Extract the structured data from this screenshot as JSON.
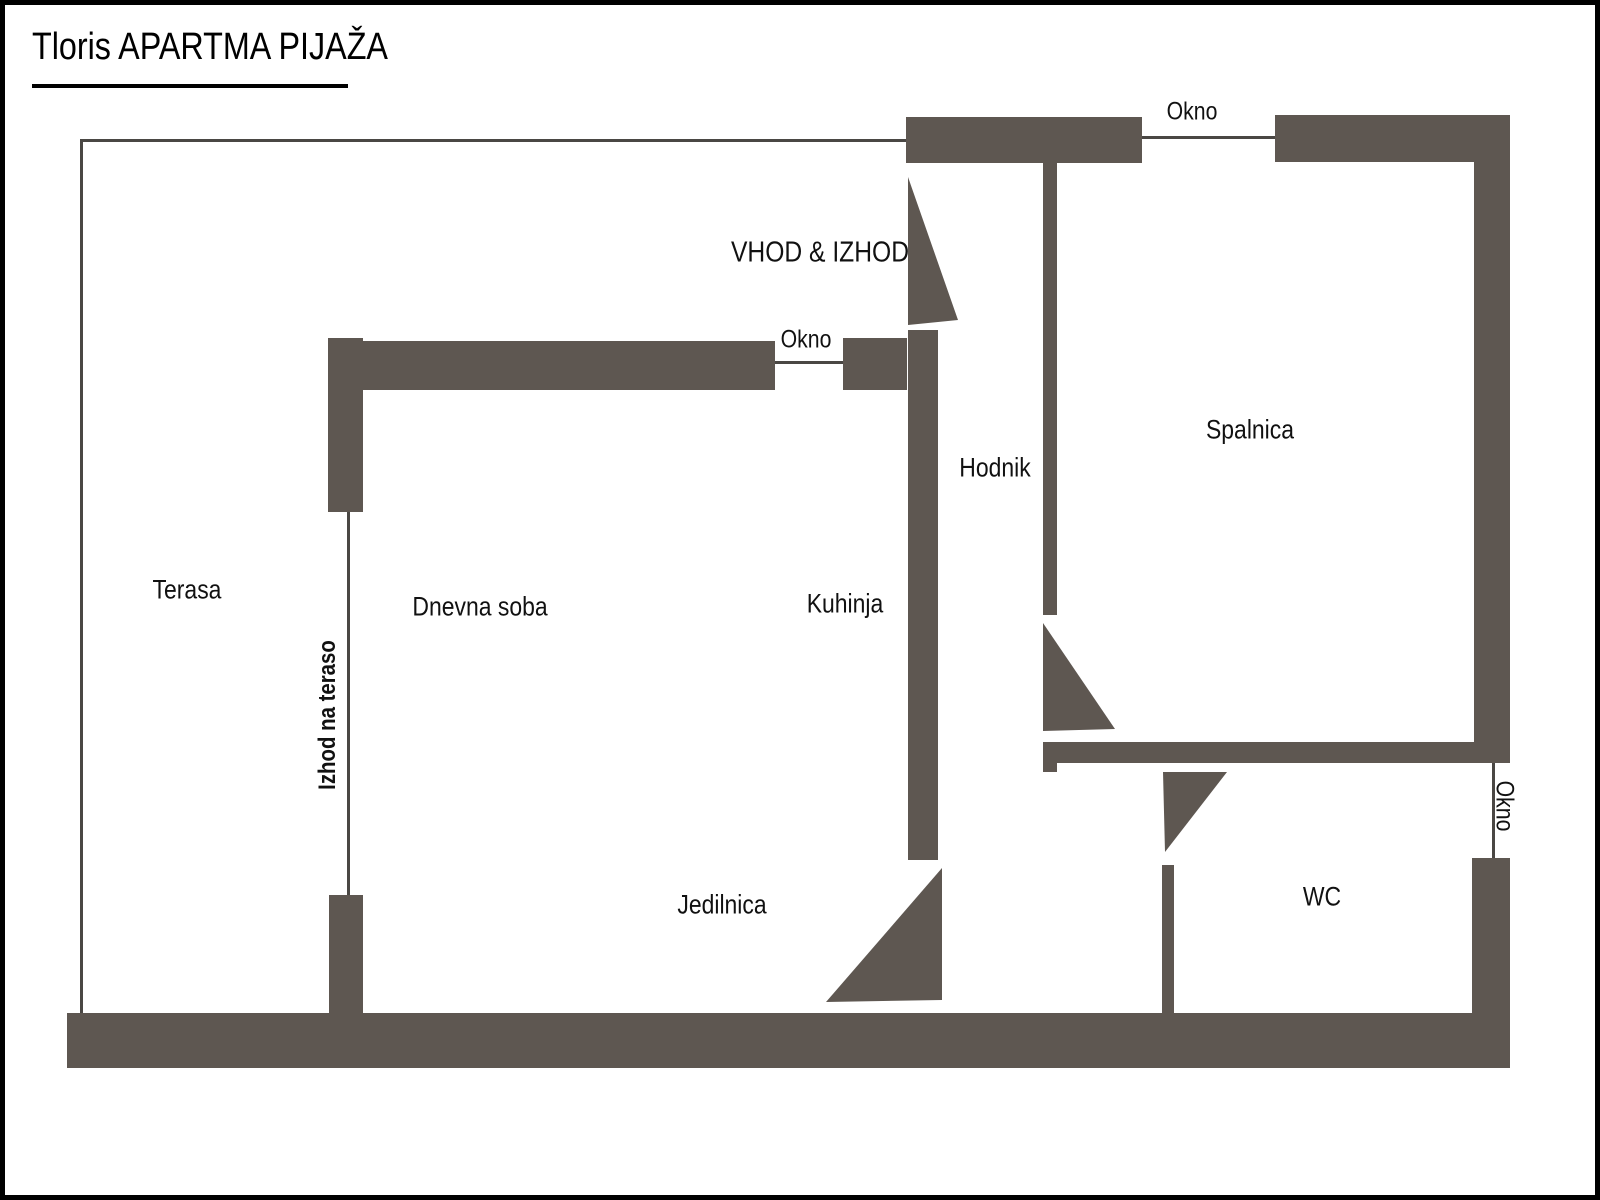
{
  "title": "Tloris APARTMA PIJAŽA",
  "rooms": {
    "terasa": "Terasa",
    "dnevna_soba": "Dnevna soba",
    "kuhinja": "Kuhinja",
    "hodnik": "Hodnik",
    "spalnica": "Spalnica",
    "jedilnica": "Jedilnica",
    "wc": "WC"
  },
  "annotations": {
    "entrance": "VHOD & IZHOD",
    "terrace_exit": "Izhod na teraso",
    "window_kitchen": "Okno",
    "window_bedroom": "Okno",
    "window_wc": "Okno"
  },
  "colors": {
    "wall": "#5e5751",
    "line": "#4a4744",
    "text": "#111111",
    "border": "#000000",
    "bg": "#ffffff"
  }
}
